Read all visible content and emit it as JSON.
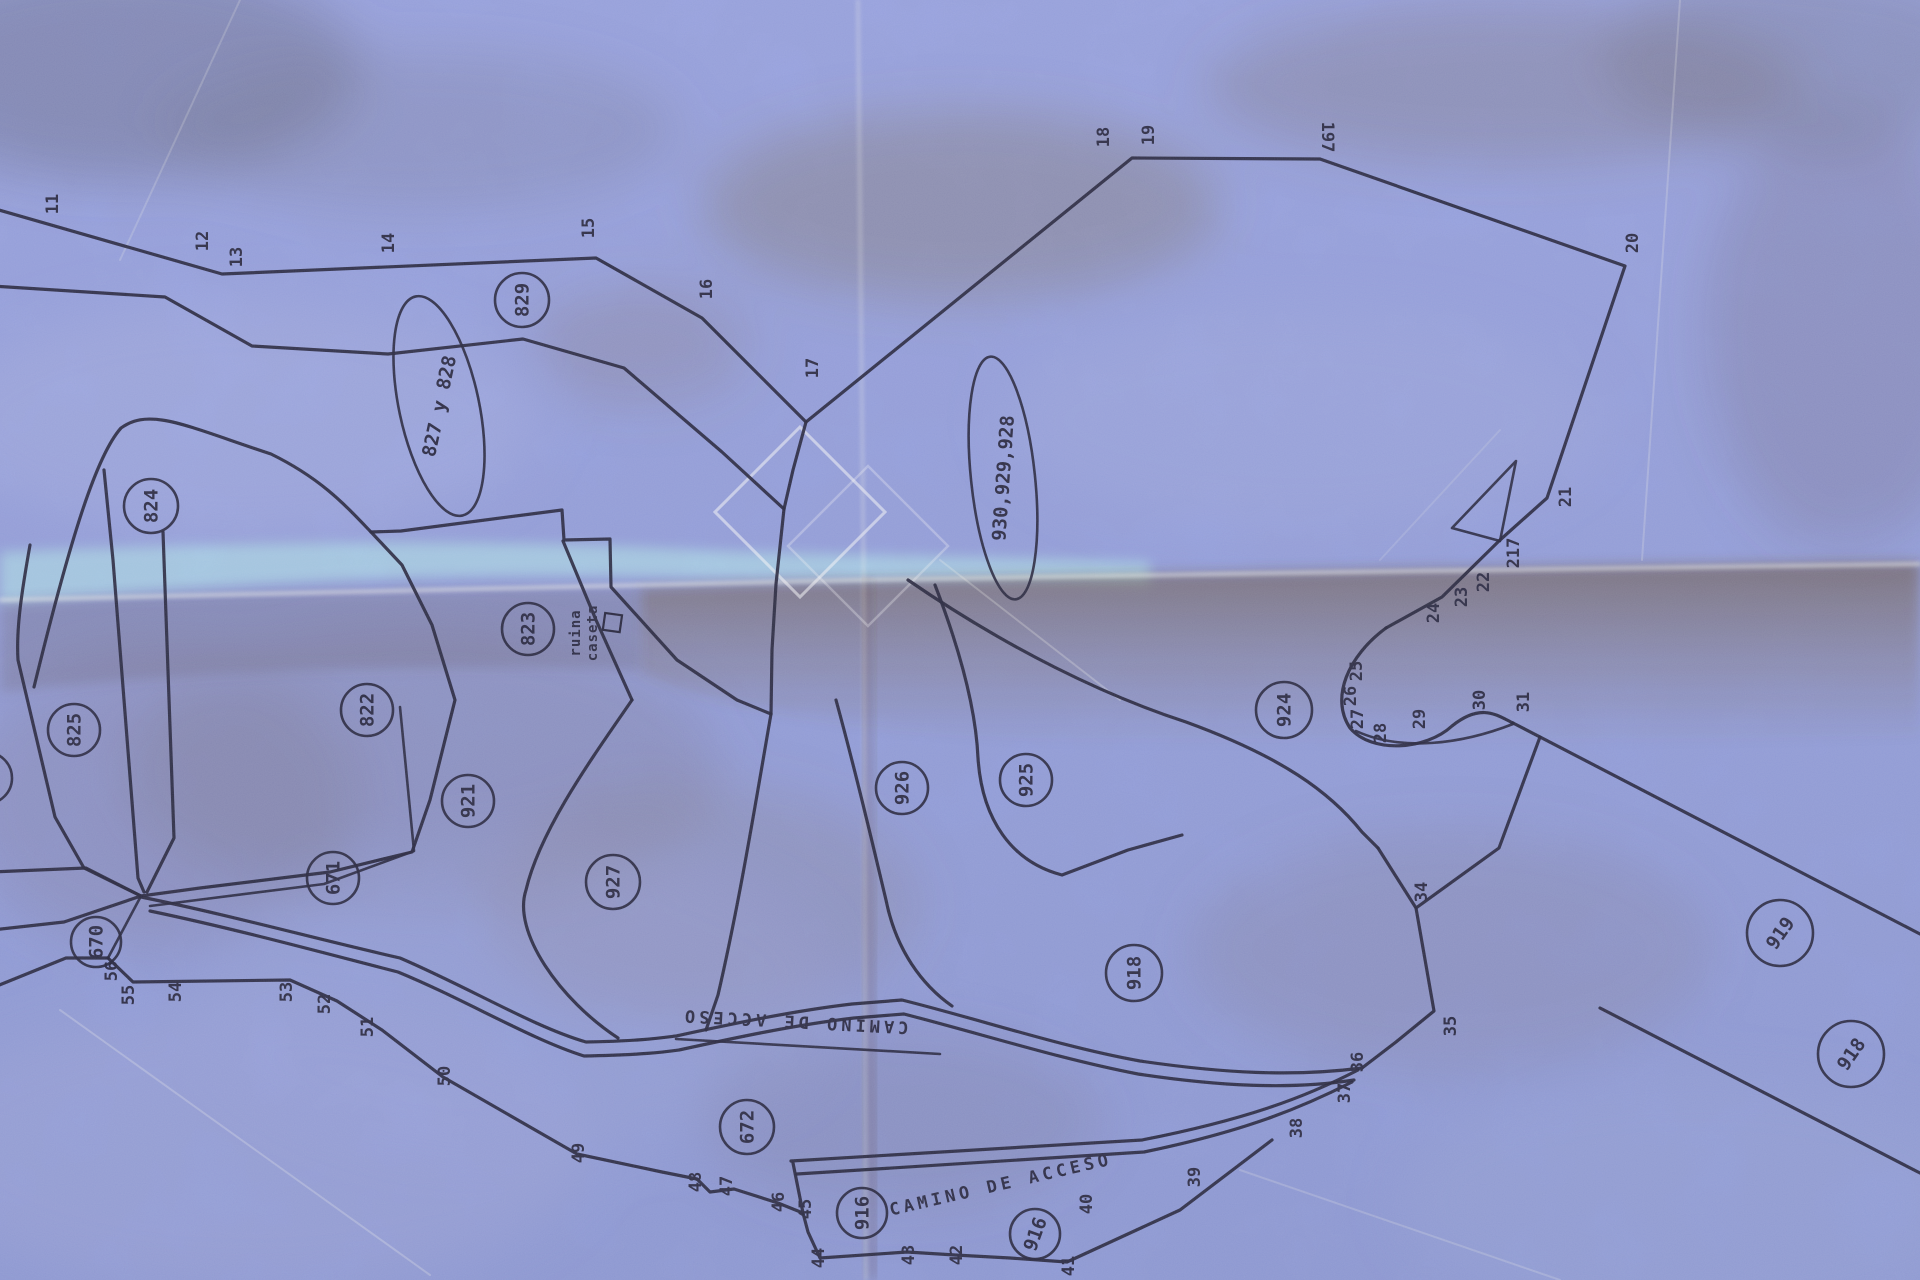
{
  "map": {
    "type": "cadastral-parcel-plan-photo",
    "road_label_reversed": "CAMINO DE ACCESO",
    "road_label": "CAMINO DE ACCESO",
    "ruin_label_line1": "ruina",
    "ruin_label_line2": "caseta",
    "colors": {
      "paper": "#8e9bd8",
      "paper_light_band": "#abdcea",
      "ink": "#1b1b33",
      "fold_shadow_brown": "#60462a",
      "crease_highlight": "#fffef2",
      "watermark": "#ffffff"
    },
    "parcel_circles": [
      {
        "label": "829",
        "x": 522,
        "y": 300,
        "r": 27,
        "rot": -90
      },
      {
        "label": "824",
        "x": 151,
        "y": 506,
        "r": 27,
        "rot": -90
      },
      {
        "label": "825",
        "x": 74,
        "y": 730,
        "r": 26,
        "rot": -90
      },
      {
        "label": "823",
        "x": 528,
        "y": 629,
        "r": 26,
        "rot": -90
      },
      {
        "label": "822",
        "x": 367,
        "y": 710,
        "r": 26,
        "rot": -90
      },
      {
        "label": "921",
        "x": 468,
        "y": 801,
        "r": 26,
        "rot": -90
      },
      {
        "label": "927",
        "x": 613,
        "y": 882,
        "r": 27,
        "rot": -90
      },
      {
        "label": "926",
        "x": 902,
        "y": 788,
        "r": 26,
        "rot": -90
      },
      {
        "label": "925",
        "x": 1026,
        "y": 780,
        "r": 26,
        "rot": -90
      },
      {
        "label": "924",
        "x": 1284,
        "y": 710,
        "r": 28,
        "rot": -90
      },
      {
        "label": "670",
        "x": 96,
        "y": 942,
        "r": 25,
        "rot": -90
      },
      {
        "label": "671",
        "x": 333,
        "y": 878,
        "r": 26,
        "rot": -90
      },
      {
        "label": "672",
        "x": 747,
        "y": 1127,
        "r": 27,
        "rot": -90
      },
      {
        "label": "916",
        "x": 862,
        "y": 1213,
        "r": 25,
        "rot": -90
      },
      {
        "label": "916",
        "x": 1035,
        "y": 1234,
        "r": 25,
        "rot": -70
      },
      {
        "label": "918",
        "x": 1134,
        "y": 973,
        "r": 28,
        "rot": -90
      },
      {
        "label": "919",
        "x": 1780,
        "y": 933,
        "r": 33,
        "rot": -55
      },
      {
        "label": "918",
        "x": 1851,
        "y": 1054,
        "r": 33,
        "rot": -55
      },
      {
        "label": "",
        "x": -14,
        "y": 778,
        "r": 26,
        "rot": -90
      }
    ],
    "parcel_ellipses": [
      {
        "label": "827 y 828",
        "x": 439,
        "y": 406,
        "rx": 40,
        "ry": 112,
        "tilt": -12,
        "text_rot": -78
      },
      {
        "label": "930,929,928",
        "x": 1003,
        "y": 478,
        "rx": 32,
        "ry": 122,
        "tilt": -6,
        "text_rot": -86
      }
    ],
    "boundary_points": [
      {
        "label": "11",
        "x": 52,
        "y": 204,
        "rot": -90
      },
      {
        "label": "12",
        "x": 202,
        "y": 241,
        "rot": -90
      },
      {
        "label": "13",
        "x": 236,
        "y": 257,
        "rot": -90
      },
      {
        "label": "14",
        "x": 388,
        "y": 243,
        "rot": -90
      },
      {
        "label": "15",
        "x": 588,
        "y": 228,
        "rot": -90
      },
      {
        "label": "16",
        "x": 706,
        "y": 289,
        "rot": -90
      },
      {
        "label": "17",
        "x": 812,
        "y": 368,
        "rot": -90
      },
      {
        "label": "18",
        "x": 1103,
        "y": 137,
        "rot": -90
      },
      {
        "label": "19",
        "x": 1148,
        "y": 135,
        "rot": -90
      },
      {
        "label": "197",
        "x": 1328,
        "y": 137,
        "rot": 90
      },
      {
        "label": "20",
        "x": 1632,
        "y": 243,
        "rot": -90
      },
      {
        "label": "21",
        "x": 1565,
        "y": 497,
        "rot": -90
      },
      {
        "label": "217",
        "x": 1513,
        "y": 553,
        "rot": -90
      },
      {
        "label": "22",
        "x": 1483,
        "y": 582,
        "rot": -90
      },
      {
        "label": "23",
        "x": 1461,
        "y": 597,
        "rot": -90
      },
      {
        "label": "24",
        "x": 1433,
        "y": 613,
        "rot": -90
      },
      {
        "label": "25",
        "x": 1356,
        "y": 671,
        "rot": -90
      },
      {
        "label": "26",
        "x": 1350,
        "y": 696,
        "rot": -90
      },
      {
        "label": "27",
        "x": 1357,
        "y": 719,
        "rot": -90
      },
      {
        "label": "28",
        "x": 1380,
        "y": 733,
        "rot": -90
      },
      {
        "label": "29",
        "x": 1419,
        "y": 719,
        "rot": -90
      },
      {
        "label": "30",
        "x": 1479,
        "y": 700,
        "rot": -90
      },
      {
        "label": "31",
        "x": 1523,
        "y": 702,
        "rot": -90
      },
      {
        "label": "34",
        "x": 1421,
        "y": 892,
        "rot": -90
      },
      {
        "label": "35",
        "x": 1450,
        "y": 1026,
        "rot": -90
      },
      {
        "label": "36",
        "x": 1357,
        "y": 1062,
        "rot": -90
      },
      {
        "label": "37",
        "x": 1344,
        "y": 1093,
        "rot": -90
      },
      {
        "label": "38",
        "x": 1296,
        "y": 1128,
        "rot": -90
      },
      {
        "label": "39",
        "x": 1194,
        "y": 1177,
        "rot": -90
      },
      {
        "label": "40",
        "x": 1086,
        "y": 1204,
        "rot": -90
      },
      {
        "label": "41",
        "x": 1068,
        "y": 1266,
        "rot": -90
      },
      {
        "label": "42",
        "x": 956,
        "y": 1255,
        "rot": -90
      },
      {
        "label": "43",
        "x": 908,
        "y": 1255,
        "rot": -90
      },
      {
        "label": "44",
        "x": 818,
        "y": 1258,
        "rot": -90
      },
      {
        "label": "45",
        "x": 805,
        "y": 1209,
        "rot": -90
      },
      {
        "label": "46",
        "x": 778,
        "y": 1202,
        "rot": -90
      },
      {
        "label": "47",
        "x": 726,
        "y": 1186,
        "rot": -90
      },
      {
        "label": "48",
        "x": 695,
        "y": 1182,
        "rot": -90
      },
      {
        "label": "49",
        "x": 578,
        "y": 1153,
        "rot": -90
      },
      {
        "label": "50",
        "x": 444,
        "y": 1076,
        "rot": -90
      },
      {
        "label": "51",
        "x": 367,
        "y": 1027,
        "rot": -90
      },
      {
        "label": "52",
        "x": 324,
        "y": 1004,
        "rot": -90
      },
      {
        "label": "53",
        "x": 286,
        "y": 992,
        "rot": -90
      },
      {
        "label": "54",
        "x": 175,
        "y": 992,
        "rot": -90
      },
      {
        "label": "55",
        "x": 128,
        "y": 995,
        "rot": -90
      },
      {
        "label": "56",
        "x": 111,
        "y": 971,
        "rot": -90
      }
    ]
  }
}
